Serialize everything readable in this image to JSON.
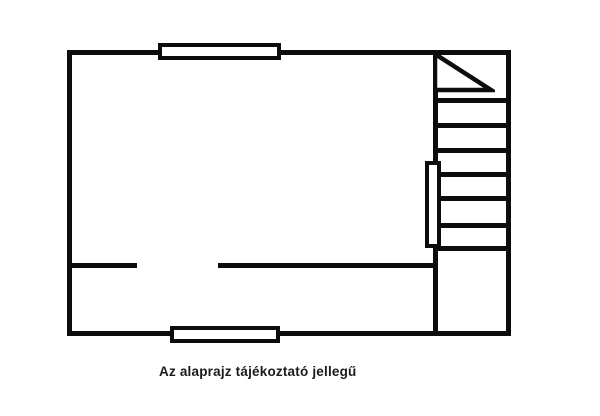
{
  "page": {
    "background_color": "#ffffff",
    "line_color": "#0d0d0d"
  },
  "caption": {
    "text": "Az alaprajz tájékoztató jellegű",
    "color": "#1b1b1b"
  },
  "floorplan": {
    "type": "floor-plan",
    "rooms": {
      "main_room": "large empty room on the left",
      "stairwell": "narrow column on the right with staircase"
    },
    "stairs": {
      "tread_count": 7,
      "direction_marker": "triangle"
    },
    "windows": {
      "count": 2,
      "positions": [
        "top wall",
        "bottom wall"
      ]
    },
    "doors": {
      "interior_wall_gap": "opening in horizontal interior wall",
      "stairwell_door": "door leaf on divider wall"
    }
  }
}
